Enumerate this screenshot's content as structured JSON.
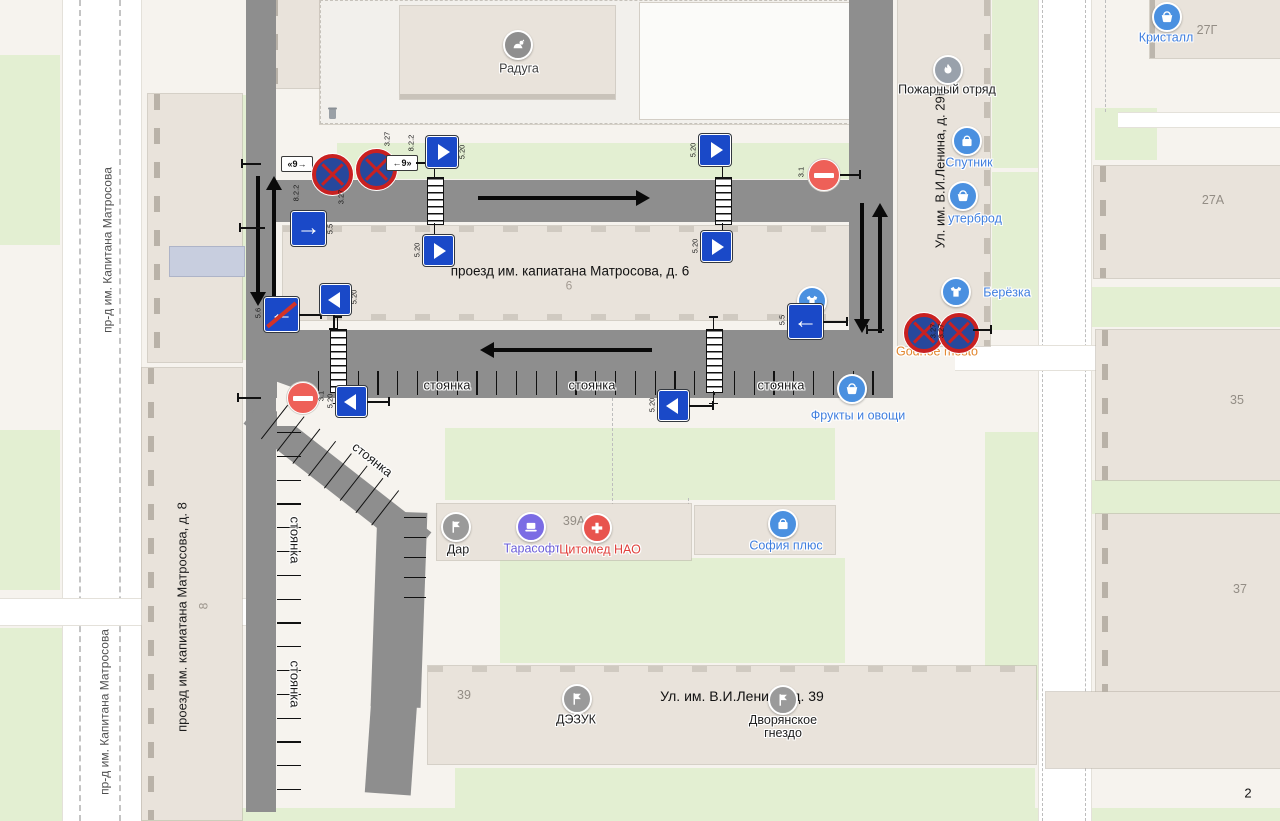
{
  "map": {
    "bg": "#f6f3ee",
    "green": "#e3efd2",
    "building": "#e9e3db",
    "scheme_road": "#8e8e8e",
    "sign_blue": "#1a49c8",
    "sign_red": "#c92121",
    "poi_blue": "#4a90e0",
    "poi_label_blue": "#3f7ede"
  },
  "page": {
    "number": "2"
  },
  "labels": [
    {
      "name": "street-label-matrosova-top",
      "text": "пр-д им. Капитана Матросова",
      "x": 108,
      "y": 250,
      "rot": -90,
      "size": 12,
      "color": "#4f4f4f"
    },
    {
      "name": "street-label-matrosova-bottom",
      "text": "пр-д им. Капитана Матросова",
      "x": 105,
      "y": 712,
      "rot": -90,
      "size": 12,
      "color": "#4f4f4f"
    },
    {
      "name": "street-label-matrosova-8",
      "text": "проезд им. капиатана Матросова, д. 8",
      "x": 183,
      "y": 617,
      "rot": -90,
      "size": 13,
      "color": "#1c1c1c"
    },
    {
      "name": "building-label-matrosova-6",
      "text": "проезд им. капиатана Матросова, д. 6",
      "x": 570,
      "y": 271,
      "rot": 0,
      "size": 13.5,
      "color": "#111111"
    },
    {
      "name": "building-number-6",
      "text": "6",
      "x": 569,
      "y": 286,
      "rot": 0,
      "size": 12,
      "color": "#a39b92"
    },
    {
      "name": "street-label-lenina-29b",
      "text": "Ул. им. В.И.Ленина, д. 29Б",
      "x": 941,
      "y": 168,
      "rot": -90,
      "size": 13,
      "color": "#161616"
    },
    {
      "name": "street-label-lenina-39",
      "text": "Ул. им. В.И.Ленина, д. 39",
      "x": 742,
      "y": 697,
      "rot": 0,
      "size": 14,
      "color": "#111111"
    },
    {
      "name": "building-number-8",
      "text": "8",
      "x": 204,
      "y": 606,
      "rot": -90,
      "size": 12,
      "color": "#9b948b"
    },
    {
      "name": "building-number-27g",
      "text": "27Г",
      "x": 1207,
      "y": 30,
      "rot": 0,
      "size": 12.5,
      "color": "#938d85"
    },
    {
      "name": "building-number-27a",
      "text": "27А",
      "x": 1213,
      "y": 200,
      "rot": 0,
      "size": 12.5,
      "color": "#938d85"
    },
    {
      "name": "building-number-35",
      "text": "35",
      "x": 1237,
      "y": 400,
      "rot": 0,
      "size": 12.5,
      "color": "#938d85"
    },
    {
      "name": "building-number-37",
      "text": "37",
      "x": 1240,
      "y": 589,
      "rot": 0,
      "size": 12.5,
      "color": "#938d85"
    },
    {
      "name": "building-number-39a",
      "text": "39А",
      "x": 574,
      "y": 521,
      "rot": 0,
      "size": 12.5,
      "color": "#938d85"
    },
    {
      "name": "building-number-39",
      "text": "39",
      "x": 464,
      "y": 695,
      "rot": 0,
      "size": 12.5,
      "color": "#938d85"
    },
    {
      "name": "parking-label-1",
      "text": "стоянка",
      "x": 447,
      "y": 386,
      "rot": 0,
      "size": 13,
      "color": "#1c1c1c",
      "halo": true
    },
    {
      "name": "parking-label-2",
      "text": "стоянка",
      "x": 592,
      "y": 386,
      "rot": 0,
      "size": 13,
      "color": "#1c1c1c",
      "halo": true
    },
    {
      "name": "parking-label-3",
      "text": "стоянка",
      "x": 781,
      "y": 386,
      "rot": 0,
      "size": 13,
      "color": "#1c1c1c",
      "halo": true
    },
    {
      "name": "parking-label-4",
      "text": "стоянка",
      "x": 294,
      "y": 540,
      "rot": 90,
      "size": 13,
      "color": "#1c1c1c",
      "halo": true
    },
    {
      "name": "parking-label-5",
      "text": "стоянка",
      "x": 294,
      "y": 684,
      "rot": 90,
      "size": 13,
      "color": "#1c1c1c",
      "halo": true
    },
    {
      "name": "parking-label-6",
      "text": "стоянка",
      "x": 372,
      "y": 460,
      "rot": 38,
      "size": 13,
      "color": "#1c1c1c",
      "halo": true
    },
    {
      "name": "page-number",
      "text": "2",
      "x": 1248,
      "y": 794,
      "rot": 0,
      "size": 13,
      "color": "#111111"
    }
  ],
  "pois": [
    {
      "name": "poi-raduga",
      "icon": "pet-icon",
      "color": "#8f8f8f",
      "x": 518,
      "y": 45,
      "label": "Радуга",
      "lx": 519,
      "ly": 69,
      "lcolor": "#3d3d3d"
    },
    {
      "name": "poi-kristall",
      "icon": "basket-icon",
      "color": "#4a90e0",
      "x": 1167,
      "y": 17,
      "label": "Кристалл",
      "lx": 1166,
      "ly": 38,
      "lcolor": "#3f7ede"
    },
    {
      "name": "poi-pozharny-otryad",
      "icon": "flame-icon",
      "color": "#99a1ab",
      "x": 948,
      "y": 70,
      "label": "Пожарный отряд",
      "lx": 947,
      "ly": 90,
      "lcolor": "#1f1f1f"
    },
    {
      "name": "poi-sputnik",
      "icon": "bag-icon",
      "color": "#4a90e0",
      "x": 967,
      "y": 141,
      "label": "Спутник",
      "lx": 969,
      "ly": 163,
      "lcolor": "#3f7ede"
    },
    {
      "name": "poi-buterbrod",
      "icon": "basket-icon",
      "color": "#4a90e0",
      "x": 963,
      "y": 196,
      "label": "утерброд",
      "lx": 975,
      "ly": 219,
      "lcolor": "#3f7ede"
    },
    {
      "name": "poi-berezka",
      "icon": "tshirt-icon",
      "color": "#4a90e0",
      "x": 956,
      "y": 292,
      "label": "Берёзка",
      "lx": 1007,
      "ly": 293,
      "lcolor": "#3f7ede"
    },
    {
      "name": "poi-godnoe-mesto",
      "icon": "basket-icon",
      "color": "#e2924a",
      "d": 15,
      "x": 931,
      "y": 328,
      "label": "Godnoe mesto",
      "lx": 937,
      "ly": 352,
      "lcolor": "#e2862e"
    },
    {
      "name": "poi-frukty-ovoshchi",
      "icon": "basket-icon",
      "color": "#4a90e0",
      "x": 852,
      "y": 389,
      "label": "Фрукты и овощи",
      "lx": 858,
      "ly": 416,
      "lcolor": "#3f7ede"
    },
    {
      "name": "poi-clothes-shop",
      "icon": "tshirt-icon",
      "color": "#4a90e0",
      "x": 812,
      "y": 301,
      "label": "",
      "lx": 0,
      "ly": 0,
      "lcolor": "#3f7ede"
    },
    {
      "name": "poi-dar",
      "icon": "flag-icon",
      "color": "#9a9a9a",
      "x": 456,
      "y": 527,
      "label": "Дар",
      "lx": 458,
      "ly": 550,
      "lcolor": "#1f1f1f"
    },
    {
      "name": "poi-tarasoft",
      "icon": "laptop-icon",
      "color": "#7b6ce4",
      "x": 531,
      "y": 527,
      "label": "Тарасофт",
      "lx": 532,
      "ly": 549,
      "lcolor": "#6a5cd8"
    },
    {
      "name": "poi-citomed-nao",
      "icon": "cross-icon",
      "color": "#e8544e",
      "x": 597,
      "y": 528,
      "label": "Цитомед НАО",
      "lx": 600,
      "ly": 550,
      "lcolor": "#e0413c"
    },
    {
      "name": "poi-sofia-plus",
      "icon": "bag-icon",
      "color": "#4a90e0",
      "x": 783,
      "y": 524,
      "label": "София плюс",
      "lx": 786,
      "ly": 546,
      "lcolor": "#3f7ede"
    },
    {
      "name": "poi-dezuk",
      "icon": "flag-icon",
      "color": "#9a9a9a",
      "x": 577,
      "y": 699,
      "label": "ДЭЗУК",
      "lx": 576,
      "ly": 720,
      "lcolor": "#1f1f1f"
    },
    {
      "name": "poi-dvoryanskoe-gnezdo",
      "icon": "flag-icon",
      "color": "#9a9a9a",
      "x": 783,
      "y": 700,
      "label": "Дворянское гнездо",
      "lx": 783,
      "ly": 727,
      "lw": 88,
      "lcolor": "#1f1f1f"
    }
  ],
  "signs": [
    {
      "name": "sign-plate-8-2-2-a",
      "type": "plq",
      "x": 281,
      "y": 156,
      "w": 30,
      "h": 14,
      "text": "«9→",
      "label": "8.2.2",
      "lx": 296,
      "ly": 193,
      "px": 261,
      "py": 163,
      "pdir": "l",
      "plen": 20
    },
    {
      "name": "sign-3-27-a",
      "type": "s327",
      "x": 312,
      "y": 154,
      "s": 33,
      "label": "3.27",
      "lx": 341,
      "ly": 197
    },
    {
      "name": "sign-3-27-b",
      "type": "s327",
      "x": 356,
      "y": 149,
      "s": 33,
      "label": "3.27",
      "lx": 387,
      "ly": 139
    },
    {
      "name": "sign-plate-8-2-2-b",
      "type": "plq",
      "x": 386,
      "y": 155,
      "w": 30,
      "h": 14,
      "text": "←9»",
      "label": "8.2.2",
      "lx": 411,
      "ly": 143,
      "px": 416,
      "py": 162,
      "pdir": "r",
      "plen": 18
    },
    {
      "name": "sign-5-20-top-1",
      "type": "s520r",
      "x": 426,
      "y": 136,
      "s": 30,
      "label": "5.20",
      "lx": 462,
      "ly": 152
    },
    {
      "name": "sign-5-20-top-2",
      "type": "s520r",
      "x": 699,
      "y": 134,
      "s": 30,
      "label": "5.20",
      "lx": 693,
      "ly": 150
    },
    {
      "name": "sign-3-1-top",
      "type": "s31",
      "x": 808,
      "y": 159,
      "s": 30,
      "label": "3.1",
      "lx": 801,
      "ly": 172,
      "px": 840,
      "py": 174,
      "pdir": "r",
      "plen": 20
    },
    {
      "name": "sign-5-5-right-arrow",
      "type": "s55r",
      "x": 291,
      "y": 211,
      "s": 33,
      "label": "5.5",
      "lx": 330,
      "ly": 229,
      "px": 265,
      "py": 227,
      "pdir": "l",
      "plen": 26
    },
    {
      "name": "sign-5-20-mid-1",
      "type": "s520r",
      "x": 423,
      "y": 235,
      "s": 29,
      "label": "5.20",
      "lx": 417,
      "ly": 250
    },
    {
      "name": "sign-5-20-mid-2",
      "type": "s520r",
      "x": 701,
      "y": 231,
      "s": 29,
      "label": "5.20",
      "lx": 695,
      "ly": 246
    },
    {
      "name": "sign-5-6-end-one-way",
      "type": "s56l",
      "x": 264,
      "y": 297,
      "s": 33,
      "label": "5.6",
      "lx": 258,
      "ly": 313,
      "px": 299,
      "py": 314,
      "pdir": "r",
      "plen": 22
    },
    {
      "name": "sign-5-20-mid-3",
      "type": "s520l",
      "x": 320,
      "y": 284,
      "s": 29,
      "label": "5.20",
      "lx": 354,
      "ly": 297,
      "px": 333,
      "py": 315,
      "pdir": "d",
      "plen": 14
    },
    {
      "name": "sign-5-5-left-arrow",
      "type": "s55l",
      "x": 788,
      "y": 304,
      "s": 33,
      "label": "5.5",
      "lx": 782,
      "ly": 320,
      "px": 823,
      "py": 321,
      "pdir": "r",
      "plen": 24
    },
    {
      "name": "sign-3-1-bottom",
      "type": "s31",
      "x": 287,
      "y": 382,
      "s": 30,
      "label": "3.1",
      "lx": 321,
      "ly": 396,
      "px": 261,
      "py": 397,
      "pdir": "l",
      "plen": 24
    },
    {
      "name": "sign-5-20-bot-1",
      "type": "s520l",
      "x": 336,
      "y": 386,
      "s": 29,
      "label": "5.20",
      "lx": 330,
      "ly": 401,
      "px": 367,
      "py": 401,
      "pdir": "r",
      "plen": 22
    },
    {
      "name": "sign-5-20-bot-2",
      "type": "s520l",
      "x": 658,
      "y": 390,
      "s": 29,
      "label": "5.20",
      "lx": 652,
      "ly": 405,
      "px": 689,
      "py": 405,
      "pdir": "r",
      "plen": 24
    },
    {
      "name": "sign-3-27-c",
      "type": "s327",
      "x": 904,
      "y": 313,
      "s": 32,
      "label": "3.27",
      "lx": 933,
      "ly": 331,
      "px": 884,
      "py": 329,
      "pdir": "l",
      "plen": 18
    },
    {
      "name": "sign-3-27-d",
      "type": "s327",
      "x": 939,
      "y": 313,
      "s": 32,
      "label": "3.27",
      "lx": 941,
      "ly": 331,
      "px": 973,
      "py": 329,
      "pdir": "r",
      "plen": 18
    }
  ],
  "arrows": [
    {
      "name": "flow-arrow-top-road-east",
      "dir": "right",
      "x": 478,
      "y": 190,
      "len": 172
    },
    {
      "name": "flow-arrow-bottom-road-west",
      "dir": "left",
      "x": 480,
      "y": 342,
      "len": 172
    },
    {
      "name": "flow-arrow-left-road-south",
      "dir": "down",
      "x": 250,
      "y": 176,
      "len": 130
    },
    {
      "name": "flow-arrow-left-road-north",
      "dir": "up",
      "x": 266,
      "y": 176,
      "len": 130
    },
    {
      "name": "flow-arrow-right-road-south",
      "dir": "down",
      "x": 854,
      "y": 203,
      "len": 130
    },
    {
      "name": "flow-arrow-right-road-north",
      "dir": "up",
      "x": 872,
      "y": 203,
      "len": 130
    }
  ],
  "humps": [
    {
      "name": "speed-hump-1",
      "x": 427,
      "y": 177,
      "w": 15,
      "h": 46
    },
    {
      "name": "speed-hump-2",
      "x": 715,
      "y": 177,
      "w": 15,
      "h": 46
    },
    {
      "name": "speed-hump-3",
      "x": 330,
      "y": 329,
      "w": 15,
      "h": 62
    },
    {
      "name": "speed-hump-4",
      "x": 706,
      "y": 329,
      "w": 15,
      "h": 62
    }
  ],
  "ticks": [
    {
      "name": "parking-ticks-bottom-strip",
      "x": 318,
      "y": 371,
      "dir": "v",
      "len": 24,
      "count": 29,
      "step": 19.8
    },
    {
      "name": "parking-ticks-left-road",
      "x": 277,
      "y": 432,
      "dir": "h",
      "len": 24,
      "count": 16,
      "step": 23.8
    },
    {
      "name": "parking-ticks-diagonal",
      "x": 288,
      "y": 404,
      "rot": 38,
      "dir": "v",
      "len": 44,
      "count": 8,
      "step": 20
    },
    {
      "name": "parking-ticks-inner",
      "x": 404,
      "y": 517,
      "dir": "h",
      "len": 22,
      "count": 5,
      "step": 20
    }
  ]
}
